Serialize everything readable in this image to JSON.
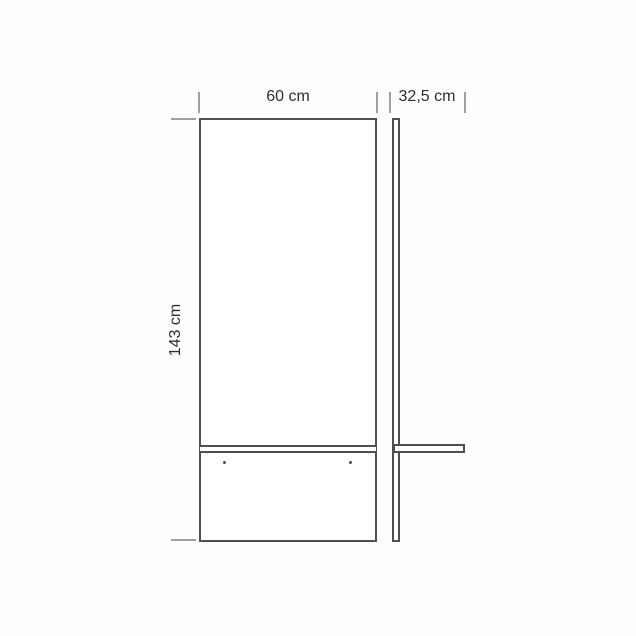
{
  "colors": {
    "background": "#fefefe",
    "outline": "#4f4f4f",
    "tick": "#9f9f9f",
    "label": "#2d2d2d"
  },
  "diagram": {
    "type": "technical-dimension-drawing",
    "views": {
      "front": {
        "name": "front elevation"
      },
      "side": {
        "name": "side elevation"
      }
    },
    "dimensions": {
      "width": {
        "label": "60 cm",
        "value": 60,
        "unit": "cm"
      },
      "depth": {
        "label": "32,5 cm",
        "value": 32.5,
        "unit": "cm"
      },
      "height": {
        "label": "143 cm",
        "value": 143,
        "unit": "cm"
      }
    }
  }
}
